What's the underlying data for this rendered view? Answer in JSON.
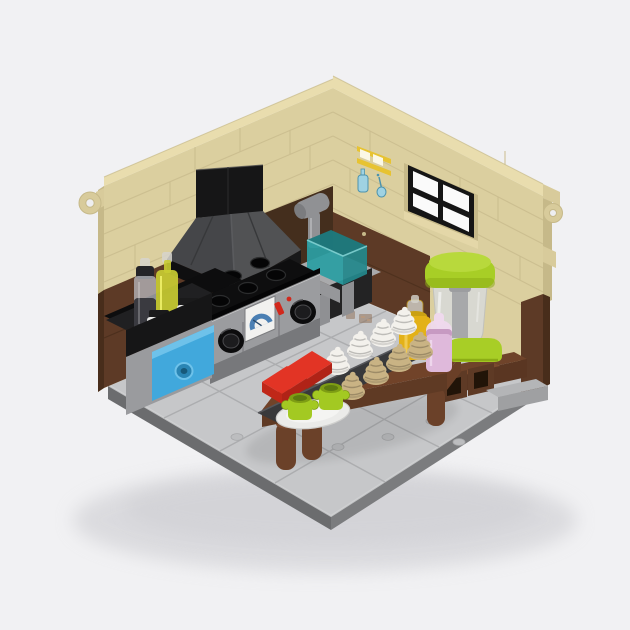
{
  "scene": {
    "title": "LEGO kitchen interior diorama",
    "description": "Isometric LEGO-built kitchen corner: tan brick walls with a black-framed window and printed utensil tile, black range hood over a gray stove with dial, teal sink with faucet, azure drawer, spice jars on a black shelf, and a reddish-brown table holding red slopes, lime cups on a plate, white and tan soft-serve swirls, a yellow jar, a pink milkshake and a lime-lidded blender, all on a light gray tiled base plate."
  },
  "parts": {
    "base": "light gray tiled floor plate",
    "left_wall": "tan brick wall with ring clip",
    "right_wall": "tan brick wall with window and ring clip",
    "window": "black-framed four-pane window",
    "wall_sticker": "printed tile: shelf with hanging blue utensils",
    "range_hood": "black chimney with dark gray hood",
    "stove": "stove with burners, two knobs and oven gauge",
    "sink": "teal basin with gray faucet and counter",
    "spice_shelf": "black shelf with grinder, oil bottle, two shakers",
    "drawer": "azure drawer with hollow stud handle",
    "table": "reddish-brown dessert table",
    "tray": "dark gray tray of swirl desserts",
    "red_slopes": "two red slope pieces",
    "cups": "two lime cups on a white plate",
    "honey_jar": "yellow jar with clear cap",
    "milkshake": "pink cup with domed lid",
    "blender": "blender with lime lid and base",
    "vent_bricks": "brown bricks with square holes",
    "corner_bricks": "light gray bricks at floor corner"
  },
  "palette": {
    "bg": "#f1f1f3",
    "shadow": "#c9c9ce",
    "floor_top": "#c6c7c9",
    "floor_top_light": "#d2d3d5",
    "floor_seam": "#a7a8aa",
    "floor_rim_left": "#6b6c6e",
    "floor_rim_right": "#7b7c7e",
    "floor_stud": "#bcbdbf",
    "wall_tan": "#dbcf9f",
    "wall_tan_light": "#e9ddae",
    "wall_tan_dark": "#c6b989",
    "mortar": "#cabd8e",
    "clip_tan": "#d8cb9b",
    "clip_hole": "#eeeef0",
    "wall_brown": "#5d3a26",
    "wall_brown_dark": "#482d1b",
    "backsplash_brown": "#442e1d",
    "panel_print": "#8a6a50",
    "window_frame": "#151515",
    "window_pane": "#fafafa",
    "window_sill": "#e4d7a8",
    "sticker_yellow": "#e7c332",
    "sticker_white": "#fbf8e6",
    "sticker_blue": "#9fd2e2",
    "sticker_blue_dark": "#4c93ad",
    "hood_black": "#161617",
    "hood_gray_left": "#454649",
    "hood_gray_right": "#515254",
    "hood_seam": "#37383a",
    "hood_edge": "#5a5b5e",
    "hood_base_left": "#0f0f10",
    "hood_base_right": "#19191a",
    "cooktop_black": "#0e0e0f",
    "burner_dark": "#050506",
    "burner_rim": "#2c2d2e",
    "stove_panel": "#9b9c9f",
    "stove_panel_dark": "#7b7c7f",
    "stove_cabinet": "#77787b",
    "knob_black": "#0c0c0d",
    "knob_hi": "#4a4a4d",
    "gauge_white": "#f1f1ef",
    "gauge_blue": "#4a7fb3",
    "lever_red": "#d1281c",
    "dark_back": "#0d0d0e",
    "counter_black": "#161617",
    "shelf_top": "#202022",
    "trans_black_upper": "#b9bbc2",
    "trans_black_lower": "#3a3a40",
    "trans_yellow": "#c9cc32",
    "trans_yellow_hi": "#eef069",
    "clear_part": "#d6d4cd",
    "jar_black": "#151516",
    "jar_white": "#ebebe9",
    "cabinet_gray": "#9a9b9e",
    "drawer_azure": "#41a8dc",
    "drawer_azure_light": "#6ec2ea",
    "drawer_azure_dark": "#2a85b4",
    "sink_counter": "#a9aaac",
    "sink_counter_dark": "#96979a",
    "sink_gap": "#232324",
    "sink_leg": "#8f9093",
    "sink_teal_top": "#1d7a7e",
    "sink_teal_front": "#2b9ea2",
    "sink_teal_side": "#23888c",
    "sink_teal_hi": "#7fd0d2",
    "faucet_gray": "#909194",
    "faucet_dark": "#7b7c7f",
    "table_top": "#714329",
    "table_front": "#5f3a24",
    "table_end": "#6a3f27",
    "leg_brown": "#6b4129",
    "leg_brown_hi": "#7d4c31",
    "leg_brown_dark": "#573320",
    "bench_top": "#6f432a",
    "bench_front": "#5a3622",
    "vent_brown": "#5e3a25",
    "vent_brown_top": "#7b4b2e",
    "vent_hole": "#211408",
    "corner_brick_top": "#b4b5b7",
    "corner_brick_front": "#9fa0a2",
    "tray_gray": "#38393b",
    "tray_edge": "#55565a",
    "slope_red": "#e23425",
    "slope_red_side": "#c02718",
    "slope_red_front": "#b02317",
    "plate_white": "#ebebe9",
    "plate_inner": "#f4f4f2",
    "plate_rim": "#cfcfcd",
    "cup_lime": "#a3c922",
    "cup_lime_dark": "#7e9d14",
    "cup_hole": "#5d7a10",
    "swirl_white": "#f3f1ec",
    "swirl_tan": "#c9b384",
    "jar_yellow": "#e3b118",
    "jar_yellow_light": "#f2cf5a",
    "jar_yellow_dark": "#caa013",
    "shake_pink": "#dfb9db",
    "shake_pink_light": "#efd9ed",
    "shake_pink_dark": "#c79ac2",
    "blender_lime": "#a8ce26",
    "blender_lime_light": "#b8d93c",
    "blender_lime_dark": "#8cad15",
    "blender_body": "#d8d9d7",
    "blender_shaft": "#a7a8aa",
    "glare_white": "#ffffff"
  }
}
